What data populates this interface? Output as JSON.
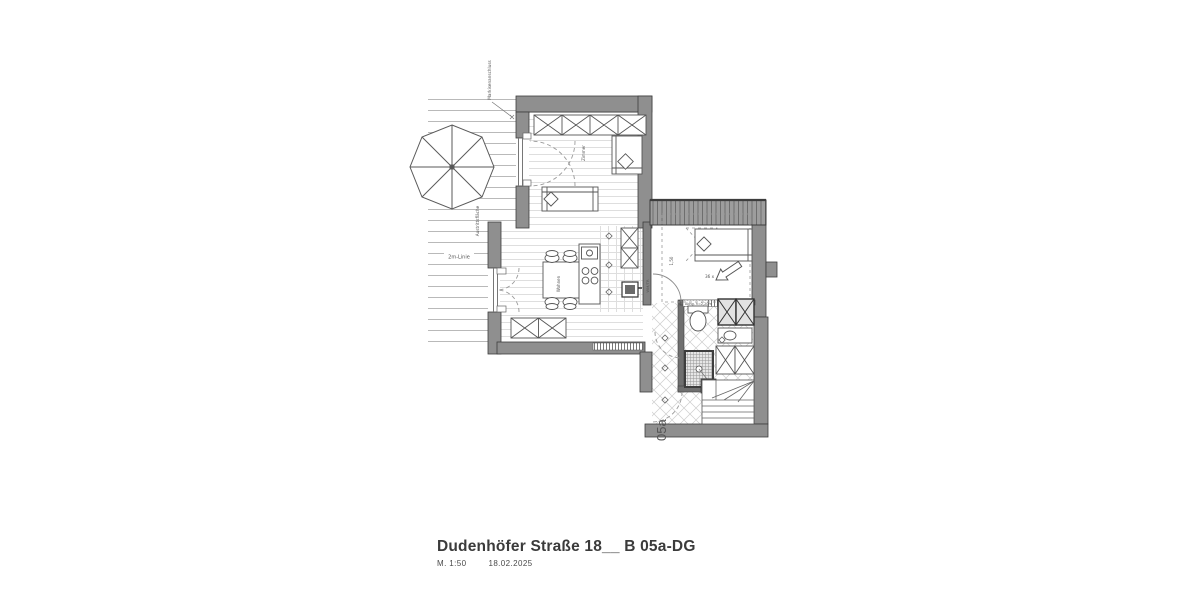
{
  "title_block": {
    "title": "Dudenhöfer Straße 18__ B 05a-DG",
    "scale": "M. 1:50",
    "date": "18.02.2025"
  },
  "labels": {
    "apartment": "05a",
    "line_2m": "2m-Linie",
    "awning": "Markisenanschluss",
    "terrace": "Austrittsfläche",
    "soffit": "Abhg. h=2,20m",
    "room1": "Zimmer",
    "living": "Wohnen",
    "wm": "WM/TR",
    "dim": "1,50",
    "steps": "36 x"
  },
  "colors": {
    "wall": "#8f8f8f",
    "wall_dark": "#6f6f6f",
    "line": "#555555",
    "plank": "#dcdcdc",
    "tile": "#cccccc",
    "text": "#3b3b3b"
  }
}
